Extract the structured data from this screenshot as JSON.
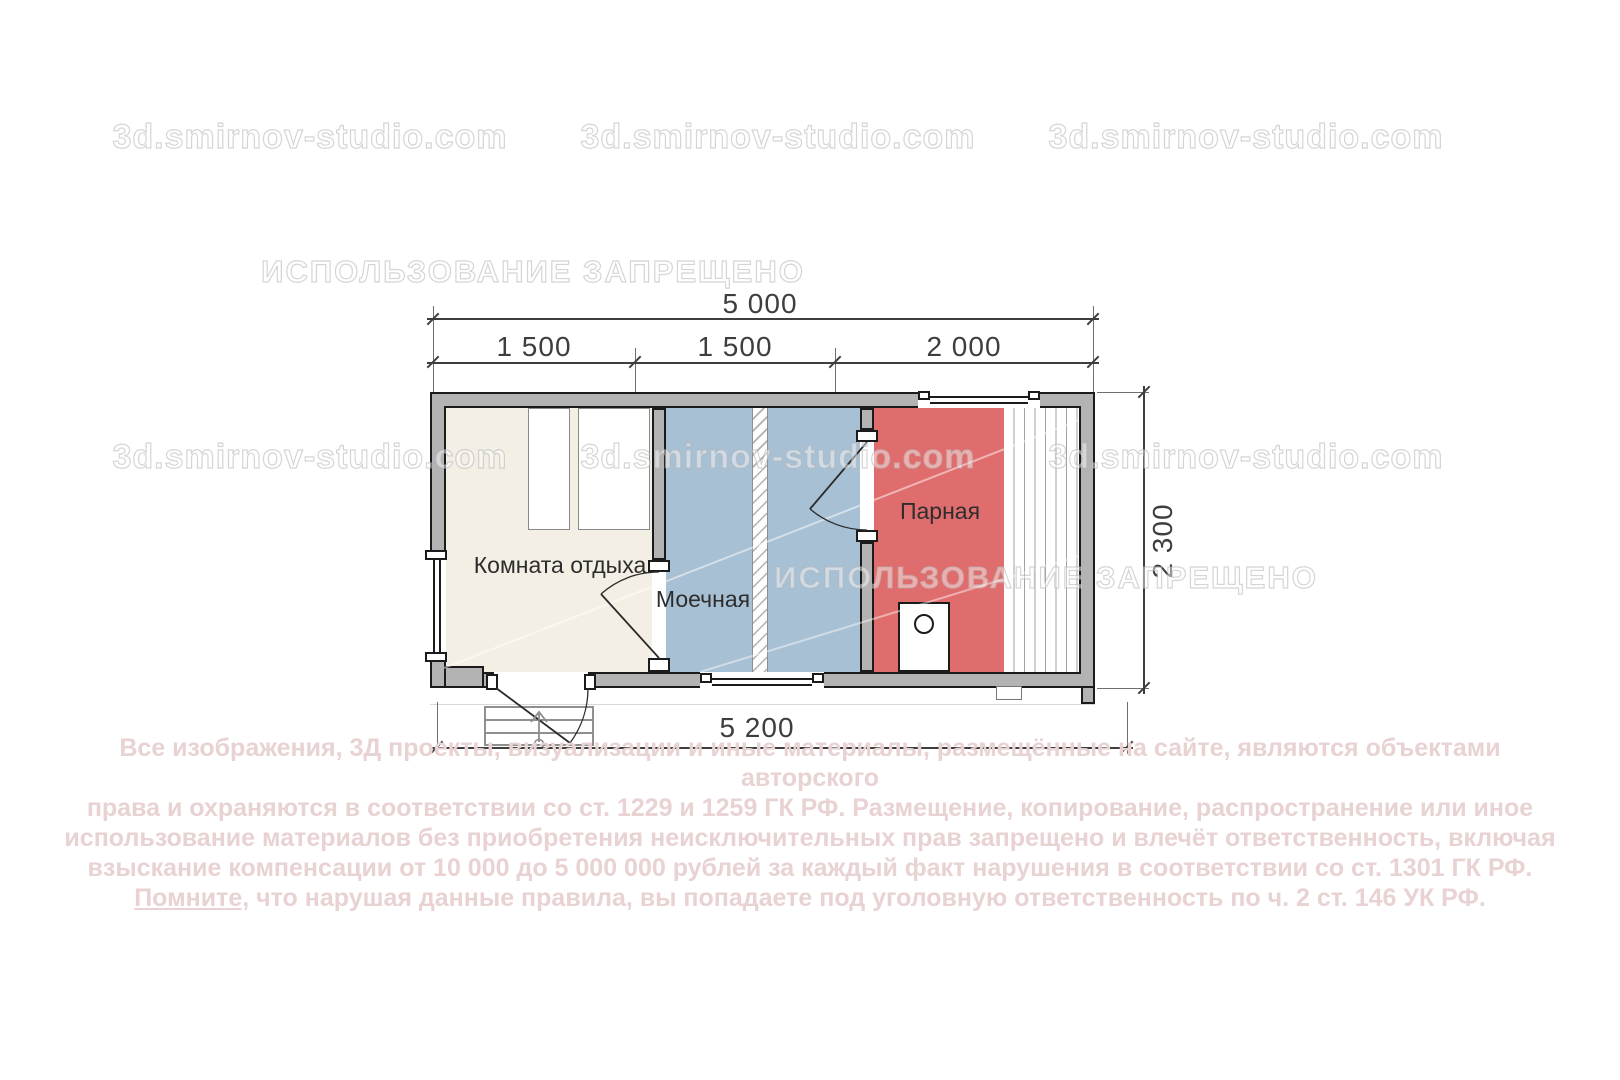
{
  "watermarks": {
    "site": "3d.smirnov-studio.com",
    "forbidden": "ИСПОЛЬЗОВАНИЕ ЗАПРЕЩЕНО"
  },
  "plan": {
    "rooms": {
      "rest": {
        "label": "Комната отдыха"
      },
      "wash": {
        "label": "Моечная"
      },
      "steam": {
        "label": "Парная"
      }
    },
    "dimensions": {
      "width_total": "5 000",
      "segments": [
        "1 500",
        "1 500",
        "2 000"
      ],
      "depth": "2 300",
      "base_width": "5 200"
    }
  },
  "copyright": {
    "lines": [
      "Все изображения, 3Д проекты, визуализации и иные материалы, размещённые на сайте, являются объектами авторского",
      "права и охраняются в соответствии со ст. 1229 и 1259 ГК РФ. Размещение, копирование, распространение или иное",
      "использование материалов без приобретения неисключительных прав запрещено и влечёт ответственность, включая",
      "взыскание компенсации от 10 000 до 5 000 000 рублей за каждый факт нарушения в соответствии со ст. 1301 ГК РФ."
    ],
    "last_line_underlined": "Помните,",
    "last_line_rest": " что нарушая данные правила, вы попадаете под уголовную ответственность по ч. 2 ст. 146 УК РФ."
  },
  "colors": {
    "room-rest": "#f4efe4",
    "room-wash": "#a8c0d3",
    "room-steam": "#e06d6d",
    "wall": "#b3b3b3",
    "outline": "#1b1b1b",
    "line": "#3e3e3e",
    "copyright": "#e8d2d2"
  }
}
